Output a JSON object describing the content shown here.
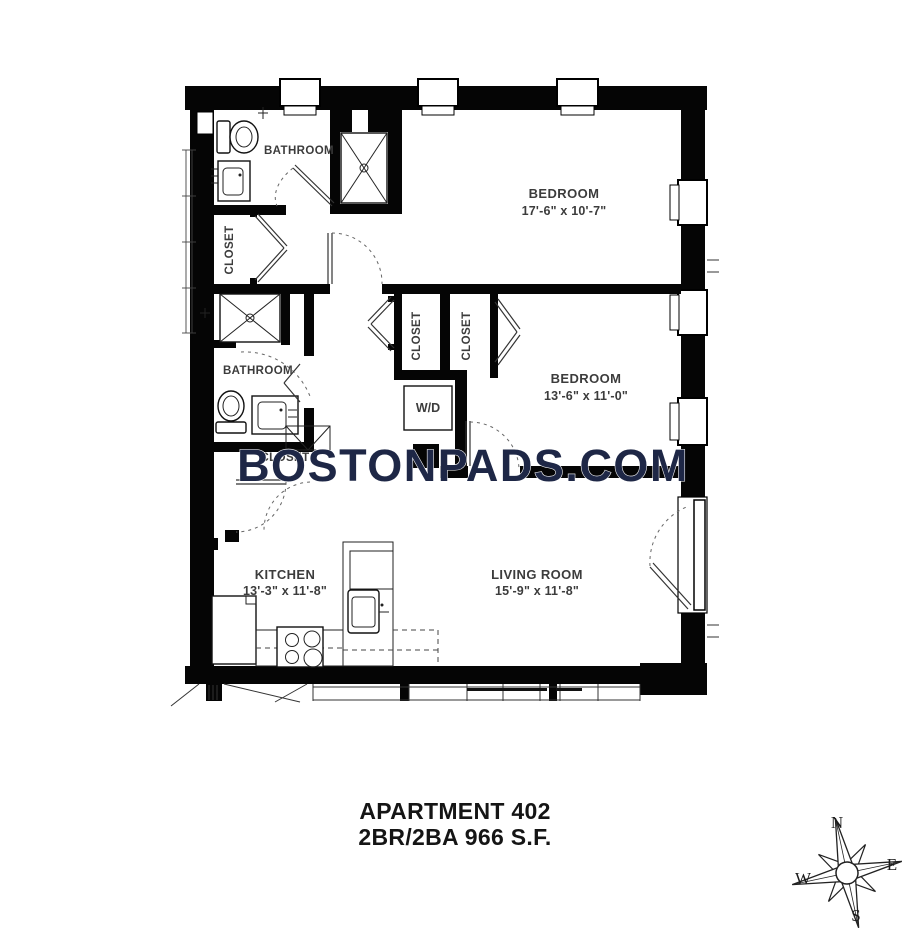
{
  "plan": {
    "watermark": "BOSTONPADS.COM",
    "rooms": {
      "bathroom1": {
        "name": "BATHROOM"
      },
      "closet1": {
        "name": "CLOSET"
      },
      "bedroom1": {
        "name": "BEDROOM",
        "dims": "17'-6\" x 10'-7\""
      },
      "closet3": {
        "name": "CLOSET"
      },
      "closet4": {
        "name": "CLOSET"
      },
      "bathroom2": {
        "name": "BATHROOM"
      },
      "closet2": {
        "name": "CLOSET"
      },
      "washer_dryer": {
        "name": "W/D"
      },
      "bedroom2": {
        "name": "BEDROOM",
        "dims": "13'-6\" x 11'-0\""
      },
      "kitchen": {
        "name": "KITCHEN",
        "dims": "13'-3\" x 11'-8\""
      },
      "living_room": {
        "name": "LIVING ROOM",
        "dims": "15'-9\" x 11'-8\""
      }
    },
    "caption": {
      "line1": "APARTMENT 402",
      "line2": "2BR/2BA 966 S.F."
    },
    "compass": {
      "north": "N",
      "east": "E",
      "south": "S",
      "west": "W"
    },
    "colors": {
      "wall": "#000000",
      "label": "#3c3c3c",
      "watermark": "#1e2746"
    }
  }
}
